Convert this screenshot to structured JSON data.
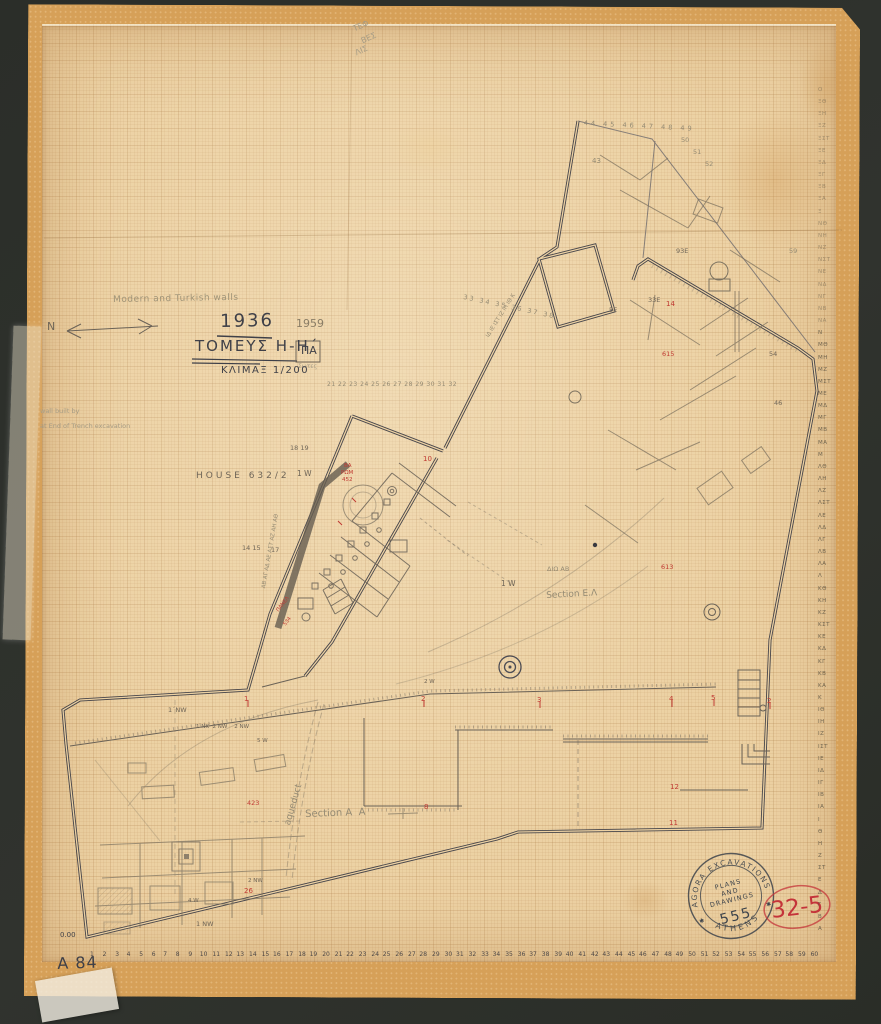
{
  "colors": {
    "ink": "#3f4048",
    "pencil": "#6f6557",
    "faint": "#948a73",
    "vfaint": "#a69c85",
    "red": "#c03a33",
    "paper": "#ecd1a3",
    "stamp_ink": "#3d434b"
  },
  "title_block": {
    "pencil_note": "Modern and Turkish walls",
    "north_label": "N",
    "year": "1936",
    "year_revision": "1959",
    "sector_title": "ΤΟΜΕΥΣ Η-Η΄",
    "sector_suffix": "ΠΑ",
    "sub_note": "Σωτες",
    "scale": "ΚΛΙΜΑΞ 1/200"
  },
  "stamp": {
    "arc_top": "AGORA EXCAVATIONS",
    "arc_bottom": "ATHENS",
    "line1": "PLANS",
    "line2": "AND",
    "line3": "DRAWINGS",
    "number": "555",
    "star": "✱"
  },
  "inventory_number_red": "32-5",
  "sheet_number": "A 84",
  "elevation_datum": "0.00",
  "scales": {
    "bottom_numbers": [
      "1",
      "2",
      "3",
      "4",
      "5",
      "6",
      "7",
      "8",
      "9",
      "10",
      "11",
      "12",
      "13",
      "14",
      "15",
      "16",
      "17",
      "18",
      "19",
      "20",
      "21",
      "22",
      "23",
      "24",
      "25",
      "26",
      "27",
      "28",
      "29",
      "30",
      "31",
      "32",
      "33",
      "34",
      "35",
      "36",
      "37",
      "38",
      "39",
      "40",
      "41",
      "42",
      "43",
      "44",
      "45",
      "46",
      "47",
      "48",
      "49",
      "50",
      "51",
      "52",
      "53",
      "54",
      "55",
      "56",
      "57",
      "58",
      "59",
      "60"
    ],
    "right_letters_top_to_bottom": [
      "Ο",
      "ΞΘ",
      "ΞΗ",
      "ΞΖ",
      "ΞΣΤ",
      "ΞΕ",
      "ΞΔ",
      "ΞΓ",
      "ΞΒ",
      "ΞΑ",
      "Ξ",
      "ΝΘ",
      "ΝΗ",
      "ΝΖ",
      "ΝΣΤ",
      "ΝΕ",
      "ΝΔ",
      "ΝΓ",
      "ΝΒ",
      "ΝΑ",
      "Ν",
      "ΜΘ",
      "ΜΗ",
      "ΜΖ",
      "ΜΣΤ",
      "ΜΕ",
      "ΜΔ",
      "ΜΓ",
      "ΜΒ",
      "ΜΑ",
      "Μ",
      "ΛΘ",
      "ΛΗ",
      "ΛΖ",
      "ΛΣΤ",
      "ΛΕ",
      "ΛΔ",
      "ΛΓ",
      "ΛΒ",
      "ΛΑ",
      "Λ",
      "ΚΘ",
      "ΚΗ",
      "ΚΖ",
      "ΚΣΤ",
      "ΚΕ",
      "ΚΔ",
      "ΚΓ",
      "ΚΒ",
      "ΚΑ",
      "Κ",
      "ΙΘ",
      "ΙΗ",
      "ΙΖ",
      "ΙΣΤ",
      "ΙΕ",
      "ΙΔ",
      "ΙΓ",
      "ΙΒ",
      "ΙΑ",
      "Ι",
      "Θ",
      "Η",
      "Ζ",
      "ΣΤ",
      "Ε",
      "Δ",
      "Γ",
      "Β",
      "Α"
    ]
  },
  "plan_labels": [
    {
      "t": "ΤΕΦ",
      "x": 352,
      "y": 26,
      "s": 8,
      "c": "vfaint",
      "rot": -24
    },
    {
      "t": "ΒΕΣ",
      "x": 360,
      "y": 38,
      "s": 8,
      "c": "vfaint",
      "rot": -24
    },
    {
      "t": "ΛΙΣ",
      "x": 354,
      "y": 50,
      "s": 8,
      "c": "vfaint",
      "rot": -24
    },
    {
      "t": "44 45 46 47 48 49",
      "x": 584,
      "y": 120,
      "s": 6.5,
      "c": "faint",
      "ls": 3,
      "rot": 3
    },
    {
      "t": "50",
      "x": 681,
      "y": 137,
      "s": 6.5,
      "c": "faint"
    },
    {
      "t": "51",
      "x": 693,
      "y": 149,
      "s": 6.5,
      "c": "faint"
    },
    {
      "t": "52",
      "x": 705,
      "y": 161,
      "s": 6.5,
      "c": "faint"
    },
    {
      "t": "43",
      "x": 592,
      "y": 158,
      "s": 7,
      "c": "faint"
    },
    {
      "t": "93Ε",
      "x": 676,
      "y": 248,
      "s": 6.5,
      "c": "pencil"
    },
    {
      "t": "59",
      "x": 789,
      "y": 248,
      "s": 6.5,
      "c": "faint"
    },
    {
      "t": "33Ε",
      "x": 648,
      "y": 297,
      "s": 6.5,
      "c": "pencil"
    },
    {
      "t": "5Ε",
      "x": 609,
      "y": 307,
      "s": 6.5,
      "c": "pencil"
    },
    {
      "t": "54",
      "x": 769,
      "y": 351,
      "s": 6.5,
      "c": "pencil"
    },
    {
      "t": "46",
      "x": 774,
      "y": 400,
      "s": 6.5,
      "c": "pencil"
    },
    {
      "t": "14",
      "x": 666,
      "y": 301,
      "s": 7,
      "c": "red",
      "n": "red-grid-number"
    },
    {
      "t": "615",
      "x": 662,
      "y": 351,
      "s": 6.5,
      "c": "red",
      "n": "red-grid-number"
    },
    {
      "t": "613",
      "x": 661,
      "y": 564,
      "s": 6.5,
      "c": "red",
      "n": "red-grid-number"
    },
    {
      "t": "33 34 35 36 37 38",
      "x": 464,
      "y": 294,
      "s": 6.5,
      "c": "faint",
      "ls": 2,
      "rot": 12
    },
    {
      "t": "ΙΔ ΙΕ ΙΣΤ ΙΖ ΙΗ ΙΘ Κ",
      "x": 486,
      "y": 336,
      "s": 5.5,
      "c": "faint",
      "rot": -58
    },
    {
      "t": "21 22 23 24 25 26 27 28 29 30 31 32",
      "x": 327,
      "y": 382,
      "s": 6,
      "c": "faint",
      "ls": 0.5
    },
    {
      "t": "18 19",
      "x": 290,
      "y": 445,
      "s": 6.5,
      "c": "pencil"
    },
    {
      "t": "HOUSE 632/2",
      "x": 196,
      "y": 472,
      "s": 9,
      "c": "pencil",
      "ls": 3,
      "n": "house-label"
    },
    {
      "t": "1 W",
      "x": 297,
      "y": 470,
      "s": 7.5,
      "c": "pencil"
    },
    {
      "t": "ΒΑ",
      "x": 344,
      "y": 464,
      "s": 5.5,
      "c": "red"
    },
    {
      "t": "ΡΩΜ",
      "x": 341,
      "y": 471,
      "s": 5.5,
      "c": "red"
    },
    {
      "t": "452",
      "x": 342,
      "y": 478,
      "s": 5.5,
      "c": "red"
    },
    {
      "t": "10",
      "x": 423,
      "y": 456,
      "s": 7,
      "c": "red"
    },
    {
      "t": "ΑΒ ΑΓ ΑΔ ΑΕ ΑΣΤ ΑΖ ΑΗ ΑΘ",
      "x": 262,
      "y": 588,
      "s": 5.5,
      "c": "faint",
      "rot": -80
    },
    {
      "t": "14 15",
      "x": 242,
      "y": 545,
      "s": 6.5,
      "c": "pencil"
    },
    {
      "t": "17",
      "x": 271,
      "y": 547,
      "s": 6.5,
      "c": "pencil"
    },
    {
      "t": "ΠΑΝΕΛ",
      "x": 276,
      "y": 610,
      "s": 5,
      "c": "red",
      "rot": -52
    },
    {
      "t": "534",
      "x": 283,
      "y": 624,
      "s": 5,
      "c": "red",
      "rot": -52
    },
    {
      "t": "ΔΙΩ ΑΒ",
      "x": 547,
      "y": 566,
      "s": 6.5,
      "c": "faint"
    },
    {
      "t": "1 W",
      "x": 501,
      "y": 580,
      "s": 7.5,
      "c": "pencil"
    },
    {
      "t": "Section Ε.Λ",
      "x": 546,
      "y": 592,
      "s": 9,
      "c": "faint",
      "rot": -3,
      "n": "section-label"
    },
    {
      "t": "1΄NW",
      "x": 168,
      "y": 707,
      "s": 6.5,
      "c": "pencil"
    },
    {
      "t": "1 NK  2 NW    2 NW",
      "x": 196,
      "y": 725,
      "s": 5.5,
      "c": "pencil"
    },
    {
      "t": "5 W",
      "x": 257,
      "y": 739,
      "s": 5.5,
      "c": "pencil"
    },
    {
      "t": "2 W",
      "x": 424,
      "y": 680,
      "s": 5.5,
      "c": "pencil"
    },
    {
      "t": "wall built by",
      "x": 40,
      "y": 408,
      "s": 6.5,
      "c": "vfaint"
    },
    {
      "t": "at End of Trench excavation",
      "x": 40,
      "y": 423,
      "s": 6.5,
      "c": "vfaint"
    },
    {
      "t": "aqueduct",
      "x": 284,
      "y": 824,
      "s": 9,
      "c": "faint",
      "rot": -74,
      "n": "aqueduct-label"
    },
    {
      "t": "Section A  A",
      "x": 305,
      "y": 810,
      "s": 10,
      "c": "faint",
      "rot": -2,
      "n": "section-label"
    },
    {
      "t": "423",
      "x": 247,
      "y": 800,
      "s": 6.5,
      "c": "red"
    },
    {
      "t": "1",
      "x": 244,
      "y": 696,
      "s": 7,
      "c": "red"
    },
    {
      "t": "2",
      "x": 421,
      "y": 696,
      "s": 7,
      "c": "red"
    },
    {
      "t": "3",
      "x": 537,
      "y": 697,
      "s": 7,
      "c": "red"
    },
    {
      "t": "4",
      "x": 669,
      "y": 696,
      "s": 7,
      "c": "red"
    },
    {
      "t": "5",
      "x": 711,
      "y": 695,
      "s": 7,
      "c": "red"
    },
    {
      "t": "2",
      "x": 767,
      "y": 698,
      "s": 7,
      "c": "red"
    },
    {
      "t": "8",
      "x": 424,
      "y": 804,
      "s": 7,
      "c": "red"
    },
    {
      "t": "12",
      "x": 670,
      "y": 784,
      "s": 7,
      "c": "red"
    },
    {
      "t": "11",
      "x": 669,
      "y": 820,
      "s": 7,
      "c": "red"
    },
    {
      "t": "26",
      "x": 244,
      "y": 888,
      "s": 7,
      "c": "red"
    },
    {
      "t": "2 NW",
      "x": 248,
      "y": 879,
      "s": 5.5,
      "c": "pencil"
    },
    {
      "t": "4 W",
      "x": 188,
      "y": 899,
      "s": 5.5,
      "c": "pencil"
    },
    {
      "t": "1 NW",
      "x": 196,
      "y": 921,
      "s": 6.5,
      "c": "pencil"
    }
  ]
}
